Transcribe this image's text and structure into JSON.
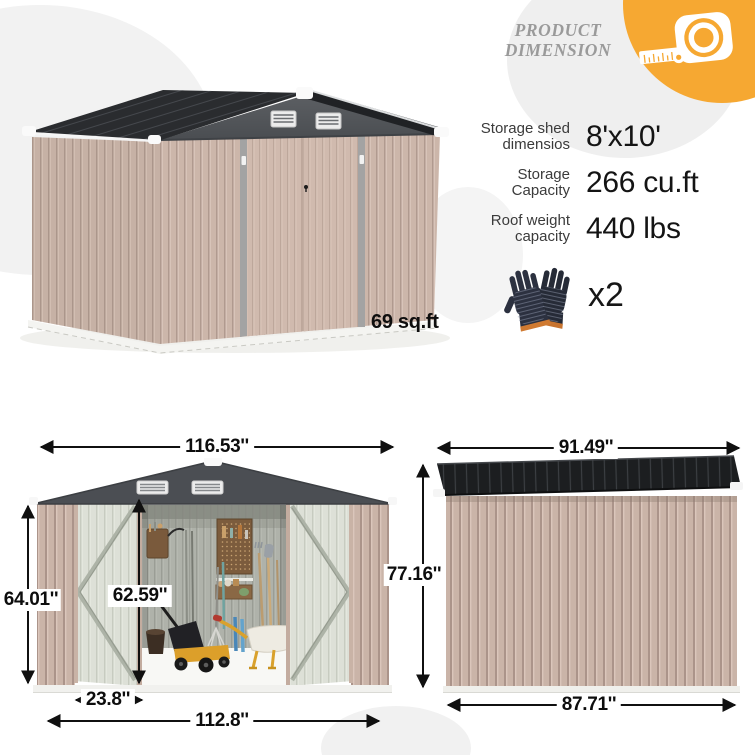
{
  "header": {
    "title_line1": "PRODUCT",
    "title_line2": "DIMENSION"
  },
  "specs": {
    "rows": [
      {
        "label1": "Storage shed",
        "label2": "dimensios",
        "value": "8'x10'"
      },
      {
        "label1": "Storage",
        "label2": "Capacity",
        "value": "266 cu.ft"
      },
      {
        "label1": "Roof weight",
        "label2": "capacity",
        "value": "440 lbs"
      }
    ]
  },
  "accessories": {
    "gloves_quantity": "x2"
  },
  "perspective_view": {
    "floor_area": "69 sq.ft"
  },
  "front_view": {
    "overall_width": "116.53''",
    "wall_height": "64.01''",
    "door_height": "62.59''",
    "door_width": "23.8''",
    "base_width": "112.8''"
  },
  "side_view": {
    "roof_length": "91.49''",
    "overall_height": "77.16''",
    "base_length": "87.71''"
  },
  "icons": {
    "badge": "tape-measure-icon",
    "accessory": "gloves-icon"
  },
  "colors": {
    "accent_orange": "#F6A832",
    "roof_dark": "#26282b",
    "wall_tan": "#cab4a8",
    "door_pale": "#dde0d7",
    "dimension_text": "#0d0d0d"
  }
}
